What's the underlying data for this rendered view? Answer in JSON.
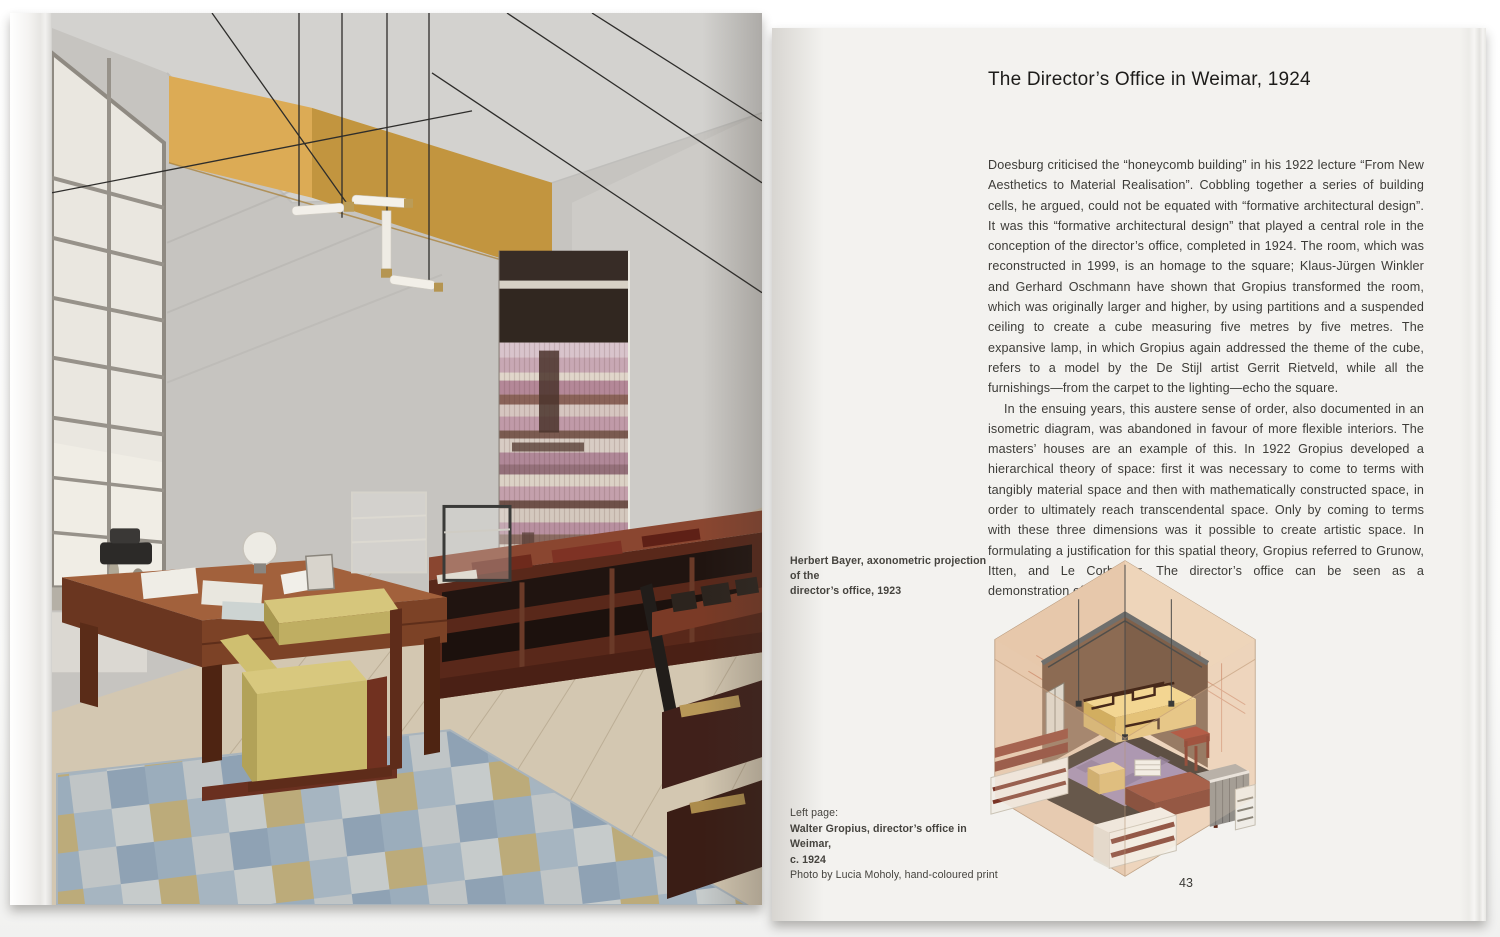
{
  "book": {
    "right_page": {
      "title": "The Director’s Office in Weimar, 1924",
      "body": {
        "p1": "Doesburg criticised the “honeycomb building” in his 1922 lecture “From New Aesthetics to Material Realisation”. Cobbling together a series of building cells, he argued, could not be equated with “formative architectural design”. It was this “formative architectural design” that played a central role in the conception of the director’s office, completed in 1924. The room, which was reconstructed in 1999, is an homage to the square; Klaus-Jürgen Winkler and Gerhard Oschmann have shown that Gropius transformed the room, which was originally larger and higher, by using partitions and a suspended ceiling to create a cube measuring five metres by five metres. The expansive lamp, in which Gropius again addressed the theme of the cube, refers to a model by the De Stijl artist Gerrit Rietveld, while all the furnishings—from the carpet to the lighting—echo the square.",
        "p2": "In the ensuing years, this austere sense of order, also documented in an isometric diagram, was abandoned in favour of more flexible interiors. The masters’ houses are an example of this. In 1922 Gropius developed a hierarchical theory of space: first it was necessary to come to terms with tangibly material space and then with mathematically constructed space, in order to ultimately reach transcendental space. Only by coming to terms with these three dimensions was it possible to create artistic space. In formulating a justification for this spatial theory, Gropius referred to Grunow, Itten, and Le Corbusier. The director’s office can be seen as a demonstration of his theory."
      },
      "figure_caption": {
        "line1": "Herbert Bayer, axonometric projection of the",
        "line2": "director’s office, 1923"
      },
      "left_page_caption": {
        "label": "Left page:",
        "work": "Walter Gropius, director’s office in Weimar,",
        "date": "c. 1924",
        "credit": "Photo by Lucia Moholy, hand-coloured print"
      },
      "page_number": "43"
    },
    "palette": {
      "paper": "#f3f2ef",
      "yellow_wall_panel": "#d2a14e",
      "carpet_blue": "#9db1c2",
      "carpet_gold": "#c0ab72",
      "chair_yellow": "#cfc079",
      "furniture_wood": "#7c4026",
      "axo_outer_wall": "#ead0b6",
      "axo_inner_wall": "#8c6b53",
      "axo_carpet": "#9a86ac",
      "axo_sofa": "#f3d692"
    }
  }
}
